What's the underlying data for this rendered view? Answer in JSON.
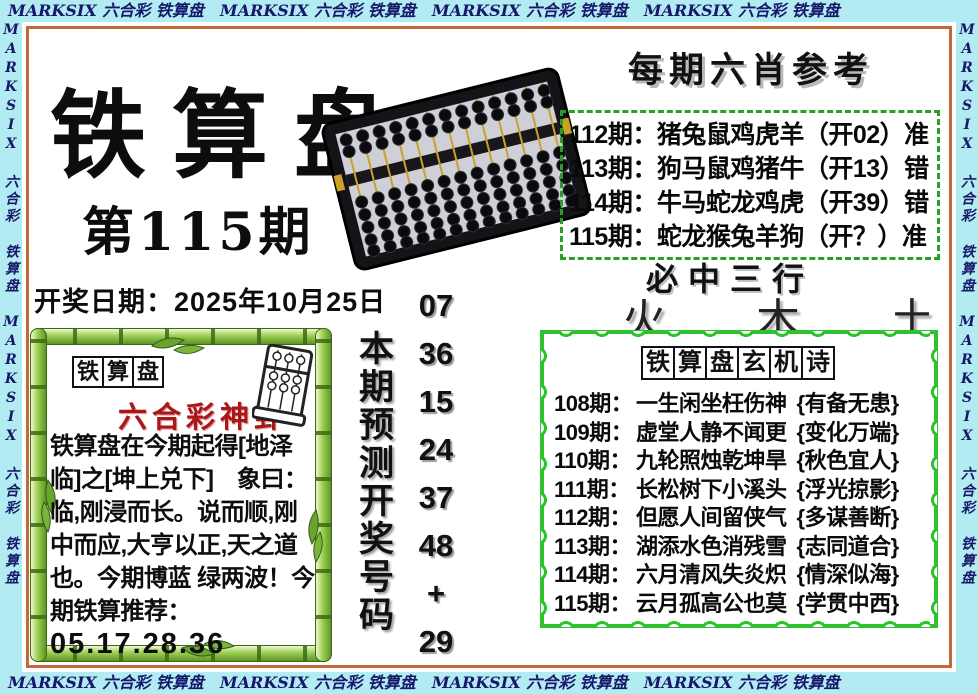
{
  "border": {
    "top_text": "MARKSIX 六合彩 铁算盘　MARKSIX 六合彩 铁算盘　MARKSIX 六合彩 铁算盘　MARKSIX 六合彩 铁算盘",
    "side_text": "MARKSIX 六合彩 铁算盘 MARKSIX 六合彩 铁算盘 MARKSIX 六合彩 铁算盘",
    "band_color": "#b2ecf2",
    "text_color": "#18186a",
    "frame_color": "#c2693a"
  },
  "header": {
    "title": "铁算盘",
    "issue": "第115期",
    "draw_date": "开奖日期：2025年10月25日"
  },
  "six_zodiac": {
    "title": "每期六肖参考",
    "rows": [
      "112期：猪兔鼠鸡虎羊（开02）准",
      "113期：狗马鼠鸡猪牛（开13）错",
      "114期：牛马蛇龙鸡虎（开39）错",
      "115期：蛇龙猴兔羊狗（开？）准"
    ],
    "border_color": "#28a028"
  },
  "prediction": {
    "label": "本期预测开奖号码",
    "numbers": [
      "07",
      "36",
      "15",
      "24",
      "37",
      "48",
      "+",
      "29"
    ]
  },
  "three_rows": {
    "title": "必中三行",
    "elements": [
      "火",
      "木",
      "土"
    ]
  },
  "mystic_poem": {
    "title": "铁算盘玄机诗",
    "border_color": "#2ec22e",
    "rows": [
      {
        "issue": "108期：",
        "poem": "一生闲坐枉伤神",
        "hint": "{有备无患}"
      },
      {
        "issue": "109期：",
        "poem": "虚堂人静不闻更",
        "hint": "{变化万端}"
      },
      {
        "issue": "110期：",
        "poem": "九轮照烛乾坤旱",
        "hint": "{秋色宜人}"
      },
      {
        "issue": "111期：",
        "poem": "长松树下小溪头",
        "hint": "{浮光掠影}"
      },
      {
        "issue": "112期：",
        "poem": "但愿人间留侠气",
        "hint": "{多谋善断}"
      },
      {
        "issue": "113期：",
        "poem": "湖添水色消残雪",
        "hint": "{志同道合}"
      },
      {
        "issue": "114期：",
        "poem": "六月清风失炎炽",
        "hint": "{情深似海}"
      },
      {
        "issue": "115期：",
        "poem": "云月孤高公也莫",
        "hint": "{学贯中西}"
      }
    ]
  },
  "bamboo_box": {
    "title": "铁算盘",
    "subtitle": "六合彩神卦",
    "body": "铁算盘在今期起得[地泽临]之[坤上兑下]　象曰：临,刚浸而长。说而顺,刚中而应,大亨以正,天之道也。今期博蓝 绿两波！今期铁算推荐：",
    "numbers": "05.17.28.36"
  },
  "icons": {
    "abacus_image": "abacus-photo",
    "mini_abacus": "abacus-sketch-icon",
    "bamboo_frame": "bamboo-frame-decoration"
  }
}
